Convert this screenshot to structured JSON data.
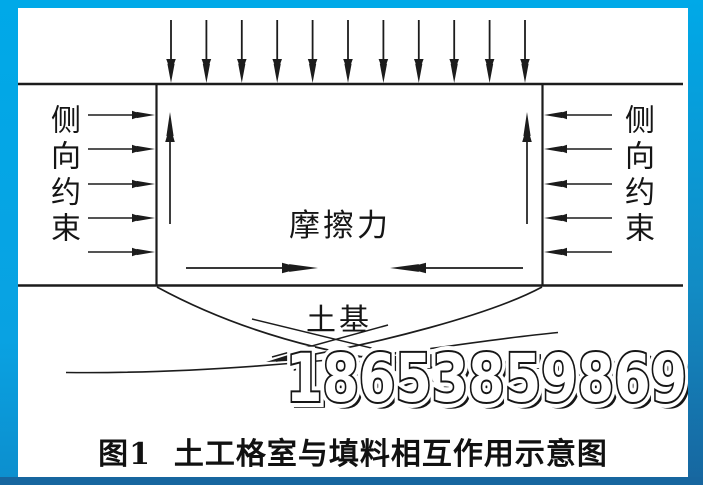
{
  "frame": {
    "accent_top_color": "#00a9e8",
    "accent_bottom_color": "#17669f"
  },
  "diagram": {
    "line_color": "#1c1c1c",
    "labels": {
      "left_constraint": "侧向约束",
      "right_constraint": "侧向约束",
      "friction": "摩擦力",
      "subgrade": "土基"
    },
    "arrows": {
      "top_load_count": 11,
      "side_constraint_rows": [
        115,
        149,
        184,
        218,
        252
      ],
      "inner_vertical_x": [
        170,
        527
      ]
    }
  },
  "watermark": {
    "text": "18653859869"
  },
  "caption": {
    "text": "图1  土工格室与填料相互作用示意图"
  }
}
